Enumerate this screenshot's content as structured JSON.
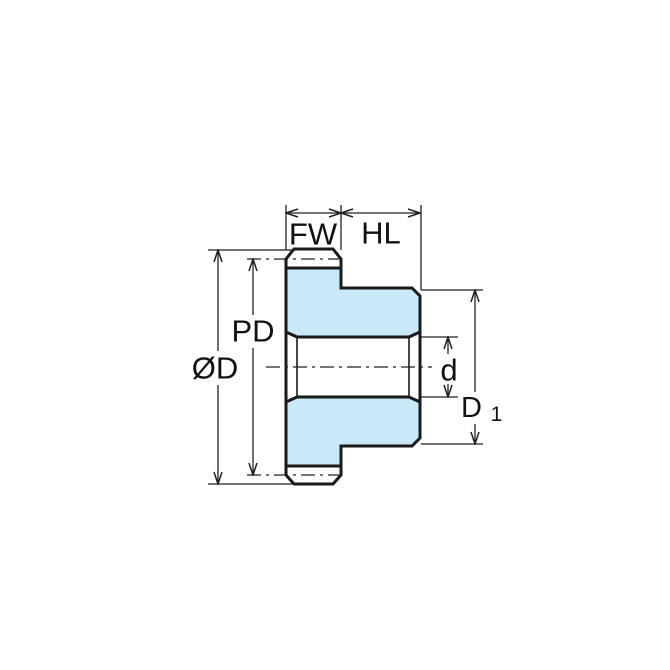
{
  "diagram": {
    "kind": "spur-gear-cross-section-dimension-drawing",
    "colors": {
      "background": "#ffffff",
      "gear_fill": "#c9e8f8",
      "outline": "#1a1a1a",
      "dimension_lines": "#222222",
      "text": "#111111"
    },
    "labels": {
      "face_width": "FW",
      "hub_length": "HL",
      "pitch_diameter": "PD",
      "outside_diameter": "ØD",
      "bore_diameter": "d",
      "hub_diameter_main": "D",
      "hub_diameter_sub": "1"
    }
  }
}
